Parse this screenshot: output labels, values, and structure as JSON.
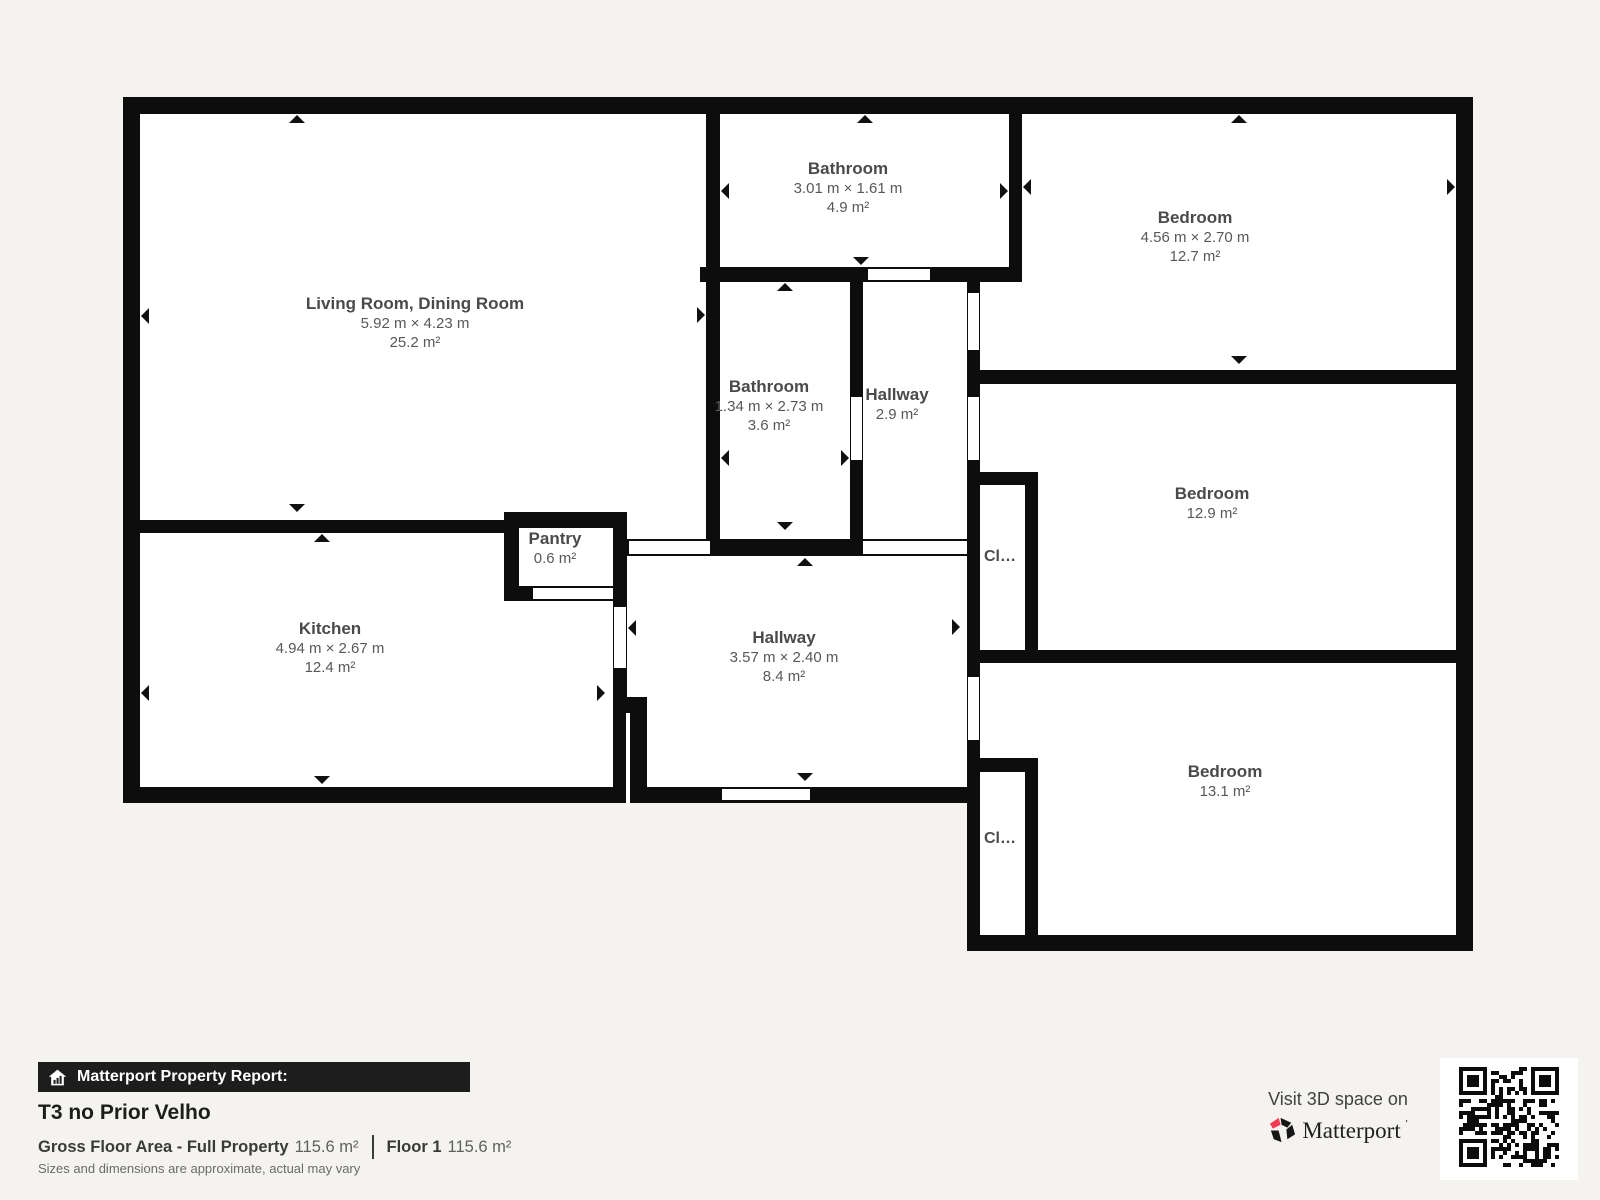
{
  "plan": {
    "rooms": [
      {
        "name": "Living Room, Dining Room",
        "dims": "5.92 m × 4.23 m",
        "area": "25.2 m²"
      },
      {
        "name": "Bathroom",
        "dims": "3.01 m × 1.61 m",
        "area": "4.9 m²"
      },
      {
        "name": "Bedroom",
        "dims": "4.56 m × 2.70 m",
        "area": "12.7 m²"
      },
      {
        "name": "Bathroom",
        "dims": "1.34 m × 2.73 m",
        "area": "3.6 m²"
      },
      {
        "name": "Hallway",
        "area": "2.9 m²"
      },
      {
        "name": "Bedroom",
        "area": "12.9 m²"
      },
      {
        "name": "Kitchen",
        "dims": "4.94 m × 2.67 m",
        "area": "12.4 m²"
      },
      {
        "name": "Pantry",
        "area": "0.6 m²"
      },
      {
        "name": "Hallway",
        "dims": "3.57 m × 2.40 m",
        "area": "8.4 m²"
      },
      {
        "name": "Bedroom",
        "area": "13.1 m²"
      },
      {
        "name": "Cl…"
      },
      {
        "name": "Cl…"
      }
    ]
  },
  "footer": {
    "report_label": "Matterport Property Report:",
    "property_title": "T3 no Prior Velho",
    "gross_label": "Gross Floor Area - Full Property",
    "gross_value": "115.6 m²",
    "floor_label": "Floor 1",
    "floor_value": "115.6 m²",
    "disclaimer": "Sizes and dimensions are approximate, actual may vary"
  },
  "cta": {
    "line1": "Visit 3D space on",
    "brand": "Matterport",
    "brand_mark": "'"
  },
  "colors": {
    "background": "#f4f3f0",
    "wall": "#0d0d0d",
    "accent_red": "#f43b52",
    "footer_bar": "#1d1d1d"
  }
}
